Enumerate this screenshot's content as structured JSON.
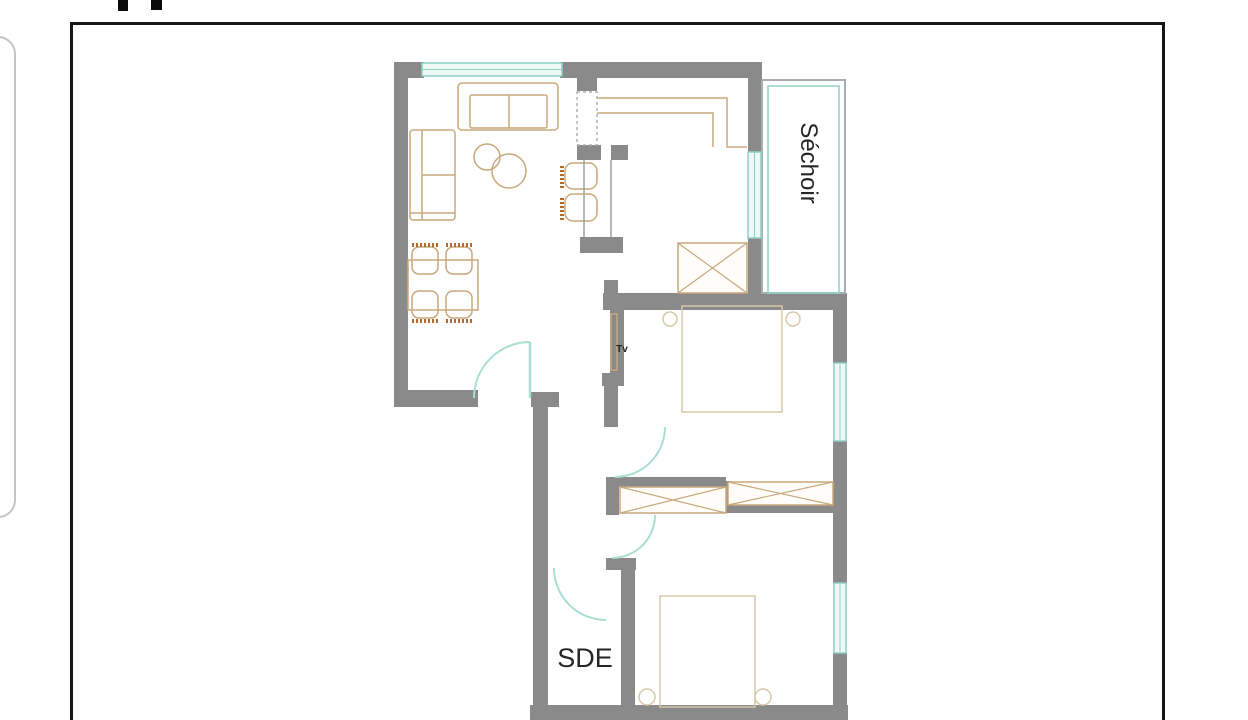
{
  "page": {
    "background": "#ffffff",
    "frame_border_color": "#161616",
    "side_card_border_color": "#c4c4c4",
    "top_mark_color": "#0a0a0a"
  },
  "floorplan": {
    "colors": {
      "wall": "#8a8a8a",
      "window_line": "#8fd0c4",
      "window_fill": "#eef9f6",
      "door": "#a9ded2",
      "furniture": "#c9a87c",
      "furniture_dark": "#b06a32",
      "bed": "#d8c8a8",
      "label": "#262626",
      "thin_wall": "#a8aeac",
      "bar": "#9aa09e",
      "dashed": "#b0b0b0",
      "closet_fill": "#fffdf9"
    },
    "labels": [
      {
        "name": "room-label-sechoir",
        "text": "Séchoir",
        "x": 801,
        "y": 163,
        "rotate": 90,
        "size": 24,
        "weight": 500
      },
      {
        "name": "room-label-sde",
        "text": "SDE",
        "x": 585,
        "y": 667,
        "rotate": 0,
        "size": 27,
        "weight": 500
      },
      {
        "name": "tv-label",
        "text": "Tv",
        "x": 622,
        "y": 352,
        "rotate": 0,
        "size": 10,
        "weight": 700
      }
    ],
    "walls": [
      {
        "x": 394,
        "y": 62,
        "w": 14,
        "h": 345,
        "name": "living-left-wall"
      },
      {
        "x": 394,
        "y": 62,
        "w": 30,
        "h": 16,
        "name": "top-left-corner"
      },
      {
        "x": 560,
        "y": 62,
        "w": 202,
        "h": 16,
        "name": "top-wall"
      },
      {
        "x": 577,
        "y": 78,
        "w": 20,
        "h": 13,
        "name": "kitchen-stub-top"
      },
      {
        "x": 577,
        "y": 145,
        "w": 24,
        "h": 15,
        "name": "kitchen-block-left"
      },
      {
        "x": 611,
        "y": 145,
        "w": 17,
        "h": 15,
        "name": "kitchen-block-right"
      },
      {
        "x": 580,
        "y": 237,
        "w": 43,
        "h": 16,
        "name": "bar-end-block"
      },
      {
        "x": 748,
        "y": 62,
        "w": 14,
        "h": 90,
        "name": "kitchen-right-wall-upper"
      },
      {
        "x": 748,
        "y": 238,
        "w": 14,
        "h": 57,
        "name": "kitchen-right-wall-lower"
      },
      {
        "x": 603,
        "y": 293,
        "w": 244,
        "h": 17,
        "name": "bedroom1-top-wall"
      },
      {
        "x": 604,
        "y": 280,
        "w": 14,
        "h": 14,
        "name": "stub-above-bedroom1-wall"
      },
      {
        "x": 833,
        "y": 293,
        "w": 14,
        "h": 70,
        "name": "right-wall-a"
      },
      {
        "x": 833,
        "y": 441,
        "w": 14,
        "h": 142,
        "name": "right-wall-b"
      },
      {
        "x": 833,
        "y": 653,
        "w": 14,
        "h": 67,
        "name": "right-wall-c"
      },
      {
        "x": 610,
        "y": 310,
        "w": 14,
        "h": 67,
        "name": "corridor-right-wall"
      },
      {
        "x": 602,
        "y": 373,
        "w": 22,
        "h": 13,
        "name": "corridor-wall-jog"
      },
      {
        "x": 604,
        "y": 386,
        "w": 14,
        "h": 41,
        "name": "corridor-wall-lower"
      },
      {
        "x": 606,
        "y": 477,
        "w": 13,
        "h": 38,
        "name": "closet-left-stub"
      },
      {
        "x": 618,
        "y": 477,
        "w": 108,
        "h": 10,
        "name": "closet-top-wall"
      },
      {
        "x": 718,
        "y": 481,
        "w": 12,
        "h": 31,
        "name": "closet-middle-stub"
      },
      {
        "x": 726,
        "y": 503,
        "w": 108,
        "h": 10,
        "name": "closet-bottom-wall"
      },
      {
        "x": 606,
        "y": 558,
        "w": 30,
        "h": 12,
        "name": "sde-top-jog"
      },
      {
        "x": 621,
        "y": 568,
        "w": 14,
        "h": 152,
        "name": "sde-right-wall"
      },
      {
        "x": 531,
        "y": 392,
        "w": 28,
        "h": 15,
        "name": "entry-side-block"
      },
      {
        "x": 533,
        "y": 407,
        "w": 15,
        "h": 313,
        "name": "left-wall-lower"
      },
      {
        "x": 398,
        "y": 390,
        "w": 80,
        "h": 17,
        "name": "living-bottom-wall"
      },
      {
        "x": 530,
        "y": 705,
        "w": 318,
        "h": 15,
        "name": "bottom-wall"
      }
    ],
    "thin_outlines": [
      {
        "x": 762,
        "y": 80,
        "w": 83,
        "h": 213,
        "color": "thin_wall",
        "sw": 2,
        "name": "sechoir-outer-line"
      },
      {
        "x": 768,
        "y": 86,
        "w": 71,
        "h": 207,
        "color": "window_line",
        "sw": 1.5,
        "name": "sechoir-glazing-line"
      }
    ],
    "windows": [
      {
        "o": "h",
        "x": 422,
        "y": 63,
        "w": 140,
        "h": 13,
        "name": "living-window"
      },
      {
        "o": "v",
        "x": 748,
        "y": 152,
        "w": 13,
        "h": 86,
        "name": "kitchen-window"
      },
      {
        "o": "v",
        "x": 834,
        "y": 363,
        "w": 12,
        "h": 78,
        "name": "bedroom1-window"
      },
      {
        "o": "v",
        "x": 834,
        "y": 583,
        "w": 12,
        "h": 70,
        "name": "bedroom2-window"
      }
    ],
    "doors": [
      {
        "name": "entry-door-arc",
        "arc": "M 474,398 A 56,56 0 0 1 530,342",
        "leaf": [
          530,
          342,
          530,
          398
        ]
      },
      {
        "name": "bedroom1-door-arc",
        "arc": "M 665,427 A 50,50 0 0 1 615,477"
      },
      {
        "name": "bedroom2-door-arc",
        "arc": "M 655,515 A 43,43 0 0 1 612,558"
      },
      {
        "name": "sde-door-arc",
        "arc": "M 554,568 A 52,52 0 0 0 606,620"
      }
    ],
    "closets": [
      {
        "x": 678,
        "y": 243,
        "w": 69,
        "h": 50,
        "name": "kitchen-closet"
      },
      {
        "x": 620,
        "y": 487,
        "w": 106,
        "h": 26,
        "name": "hall-closet"
      },
      {
        "x": 728,
        "y": 482,
        "w": 105,
        "h": 23,
        "name": "bedroom2-closet"
      }
    ],
    "furniture": {
      "rects": [
        {
          "x": 458,
          "y": 83,
          "w": 100,
          "h": 47,
          "rx": 4,
          "name": "sofa"
        },
        {
          "x": 470,
          "y": 95,
          "w": 77,
          "h": 33,
          "rx": 2,
          "name": "sofa-seat"
        },
        {
          "x": 410,
          "y": 130,
          "w": 45,
          "h": 90,
          "rx": 3,
          "name": "side-sofa"
        },
        {
          "x": 408,
          "y": 260,
          "w": 70,
          "h": 50,
          "name": "dining-table"
        },
        {
          "x": 412,
          "y": 247,
          "w": 26,
          "h": 27,
          "rx": 7,
          "name": "dining-chair"
        },
        {
          "x": 446,
          "y": 247,
          "w": 26,
          "h": 27,
          "rx": 7,
          "name": "dining-chair"
        },
        {
          "x": 412,
          "y": 291,
          "w": 26,
          "h": 27,
          "rx": 7,
          "name": "dining-chair"
        },
        {
          "x": 446,
          "y": 291,
          "w": 26,
          "h": 27,
          "rx": 7,
          "name": "dining-chair"
        },
        {
          "x": 565,
          "y": 163,
          "w": 32,
          "h": 26,
          "rx": 8,
          "name": "bar-stool"
        },
        {
          "x": 565,
          "y": 194,
          "w": 32,
          "h": 27,
          "rx": 8,
          "name": "bar-stool"
        },
        {
          "x": 682,
          "y": 306,
          "w": 100,
          "h": 106,
          "c": "bed",
          "name": "bed-1"
        },
        {
          "x": 660,
          "y": 596,
          "w": 95,
          "h": 111,
          "c": "bed",
          "name": "bed-2"
        },
        {
          "x": 611,
          "y": 314,
          "w": 6,
          "h": 56,
          "name": "tv"
        },
        {
          "x": 577,
          "y": 92,
          "w": 20,
          "h": 53,
          "c": "dashed",
          "dash": "3 3",
          "name": "kitchen-tall-cabinet"
        }
      ],
      "circles": [
        {
          "cx": 487,
          "cy": 157,
          "r": 13,
          "name": "coffee-table"
        },
        {
          "cx": 509,
          "cy": 171,
          "r": 17,
          "name": "coffee-table"
        },
        {
          "cx": 670,
          "cy": 319,
          "r": 7,
          "c": "bed",
          "name": "bedside-lamp"
        },
        {
          "cx": 793,
          "cy": 319,
          "r": 7,
          "c": "bed",
          "name": "bedside-lamp"
        },
        {
          "cx": 647,
          "cy": 697,
          "r": 8,
          "c": "bed",
          "name": "bedside-lamp"
        },
        {
          "cx": 763,
          "cy": 697,
          "r": 8,
          "c": "bed",
          "name": "bedside-lamp"
        }
      ],
      "lines": [
        {
          "x1": 509,
          "y1": 95,
          "x2": 509,
          "y2": 128,
          "name": "sofa-divider"
        },
        {
          "x1": 422,
          "y1": 130,
          "x2": 422,
          "y2": 220,
          "name": "side-sofa-back"
        },
        {
          "x1": 422,
          "y1": 175,
          "x2": 455,
          "y2": 175,
          "name": "side-sofa-divider"
        },
        {
          "x1": 410,
          "y1": 213,
          "x2": 455,
          "y2": 213,
          "name": "side-sofa-end"
        },
        {
          "x1": 584,
          "y1": 160,
          "x2": 584,
          "y2": 237,
          "c": "bar",
          "name": "bar-counter-line"
        },
        {
          "x1": 611,
          "y1": 160,
          "x2": 611,
          "y2": 237,
          "c": "bar",
          "name": "bar-counter-line"
        },
        {
          "x1": 412,
          "y1": 245,
          "x2": 438,
          "y2": 245,
          "c": "furniture_dark",
          "sw": 4,
          "dash": "2 2",
          "name": "chair-back-hatch"
        },
        {
          "x1": 446,
          "y1": 245,
          "x2": 472,
          "y2": 245,
          "c": "furniture_dark",
          "sw": 4,
          "dash": "2 2",
          "name": "chair-back-hatch"
        },
        {
          "x1": 412,
          "y1": 321,
          "x2": 438,
          "y2": 321,
          "c": "furniture_dark",
          "sw": 4,
          "dash": "2 2",
          "name": "chair-back-hatch"
        },
        {
          "x1": 446,
          "y1": 321,
          "x2": 472,
          "y2": 321,
          "c": "furniture_dark",
          "sw": 4,
          "dash": "2 2",
          "name": "chair-back-hatch"
        },
        {
          "x1": 562,
          "y1": 166,
          "x2": 562,
          "y2": 188,
          "c": "furniture_dark",
          "sw": 4,
          "dash": "2 2",
          "name": "stool-back-hatch"
        },
        {
          "x1": 562,
          "y1": 198,
          "x2": 562,
          "y2": 220,
          "c": "furniture_dark",
          "sw": 4,
          "dash": "2 2",
          "name": "stool-back-hatch"
        }
      ],
      "paths": [
        {
          "d": "M 597,98 L 727,98 L 727,147 L 747,147",
          "name": "kitchen-counter-outer"
        },
        {
          "d": "M 597,113 L 713,113 L 713,147",
          "name": "kitchen-counter-inner"
        }
      ]
    }
  }
}
